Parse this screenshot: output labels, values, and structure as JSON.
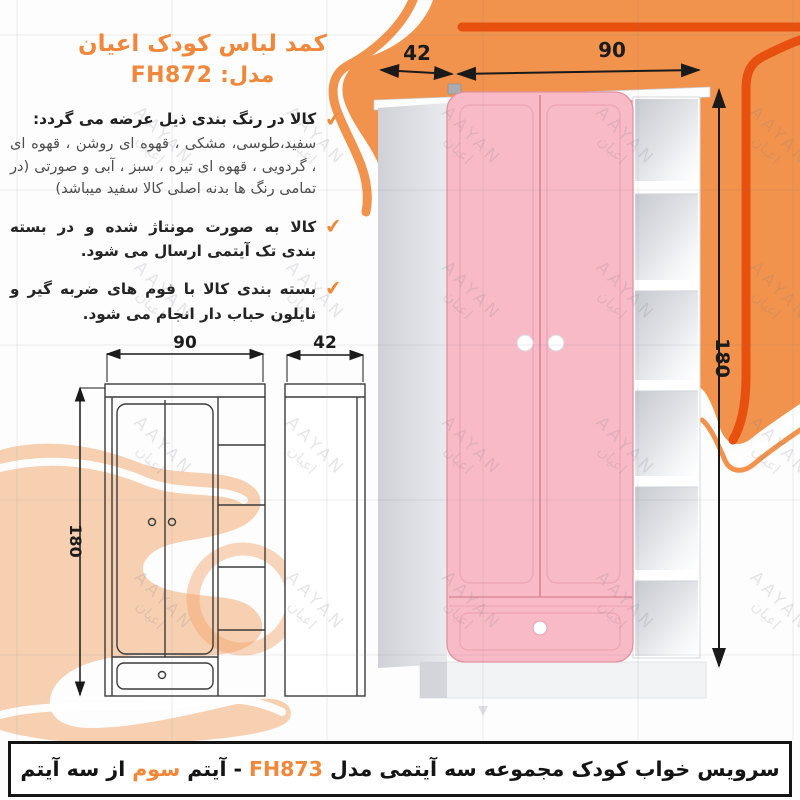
{
  "title": {
    "line1": "کمد لباس کودک اعیان",
    "model_label": "مدل:",
    "model_code": "FH872"
  },
  "bullets": [
    {
      "header": "کالا در رنگ بندی ذیل عرضه می گردد:",
      "body": "سفید،طوسی، مشکی ، قهوه ای روشن ، قهوه ای ، گردویی ، قهوه ای تیره ، سبز ، آبی و صورتی (در تمامی رنگ ها بدنه اصلی کالا سفید میباشد)"
    },
    {
      "text": "کالا به صورت مونتاژ شده و در بسته بندی تک آیتمی ارسال می شود."
    },
    {
      "text": "بسته بندی کالا با فوم های ضربه گیر و نایلون حباب دار انجام می شود."
    }
  ],
  "dimensions": {
    "top_depth": "42",
    "top_width": "90",
    "height_3d": "180",
    "front_width": "90",
    "front_height": "180",
    "side_depth": "42"
  },
  "watermark": {
    "latin": "AAYAN",
    "farsi": "اعیان"
  },
  "footer": {
    "text_start": "سرویس خواب کودک مجموعه سه آیتمی مدل",
    "model_code": "FH873",
    "dash": "-",
    "text_mid": "آیتم",
    "highlight": "سوم",
    "text_end": "از سه آیتم"
  },
  "colors": {
    "accent_orange": "#f0873a",
    "blob_orange": "#f2934d",
    "deep_orange": "#e8500f",
    "door_pink": "#f9bac7",
    "text_dark": "#1f1f1f"
  }
}
